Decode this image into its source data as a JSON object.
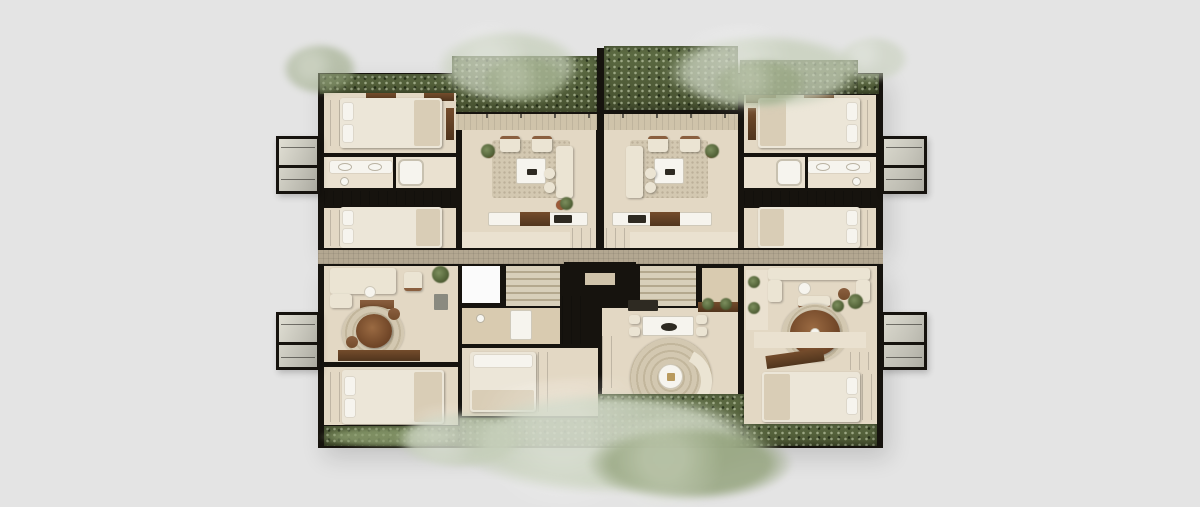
{
  "scene": {
    "description": "Top-down photorealistic render of a residential floor plan: four corner suites around a central stair and elevator core, glass balcony boxes on the east and west facades, planted green roof strips and overhanging sage tree canopies on a plain light-gray background. No visible text.",
    "building": {
      "core": {
        "elements": [
          "lobby-void",
          "stair-flight-left",
          "elevator",
          "stair-flight-right",
          "landing"
        ]
      },
      "units": [
        {
          "id": "upper-left-suite",
          "rooms": [
            "bedroom",
            "bathroom",
            "bedroom",
            "living-room"
          ],
          "balcony": "west"
        },
        {
          "id": "upper-right-suite",
          "rooms": [
            "living-room",
            "bathroom",
            "bedroom",
            "bedroom"
          ],
          "balcony": "east"
        },
        {
          "id": "lower-left-suite",
          "rooms": [
            "living-dining",
            "bedroom"
          ],
          "balcony": "west"
        },
        {
          "id": "lower-center-suite",
          "rooms": [
            "dining-area",
            "round-lounge"
          ],
          "balcony": "none"
        },
        {
          "id": "lower-right-suite",
          "rooms": [
            "living-dining",
            "bedroom"
          ],
          "balcony": "east"
        }
      ],
      "landscape": [
        "green-roof-strip-north",
        "garden-strip-south",
        "tree-canopies"
      ]
    }
  },
  "palette": {
    "bg": "#e4e4e4",
    "wall": "#16130e",
    "floor": "#e3d8c4",
    "floor_light": "#eae1d0",
    "floor_warm": "#d9cbb0",
    "walkway": "#cfc3aa",
    "band": "#b3a791",
    "wood": "#744c2c",
    "wood_dark": "#50351d",
    "wood_mid": "#8a5f3f",
    "bedding": "#ece6d8",
    "bedding_shadow": "#d9cdb6",
    "sofa": "#ebe4d3",
    "rug": "#d3c8b1",
    "rug_ring": "#c2b69c",
    "white": "#f6f4ee",
    "green_dark": "#46502f",
    "green_mid": "#5f6e45",
    "green_sage": "#95a47e",
    "green_pale": "#c6cfba",
    "terracotta": "#9c5a38",
    "stair": "#d8cfba",
    "stair_shadow": "#b4a88e",
    "void": "#fbfbfb",
    "dark_item": "#2e2a22"
  }
}
